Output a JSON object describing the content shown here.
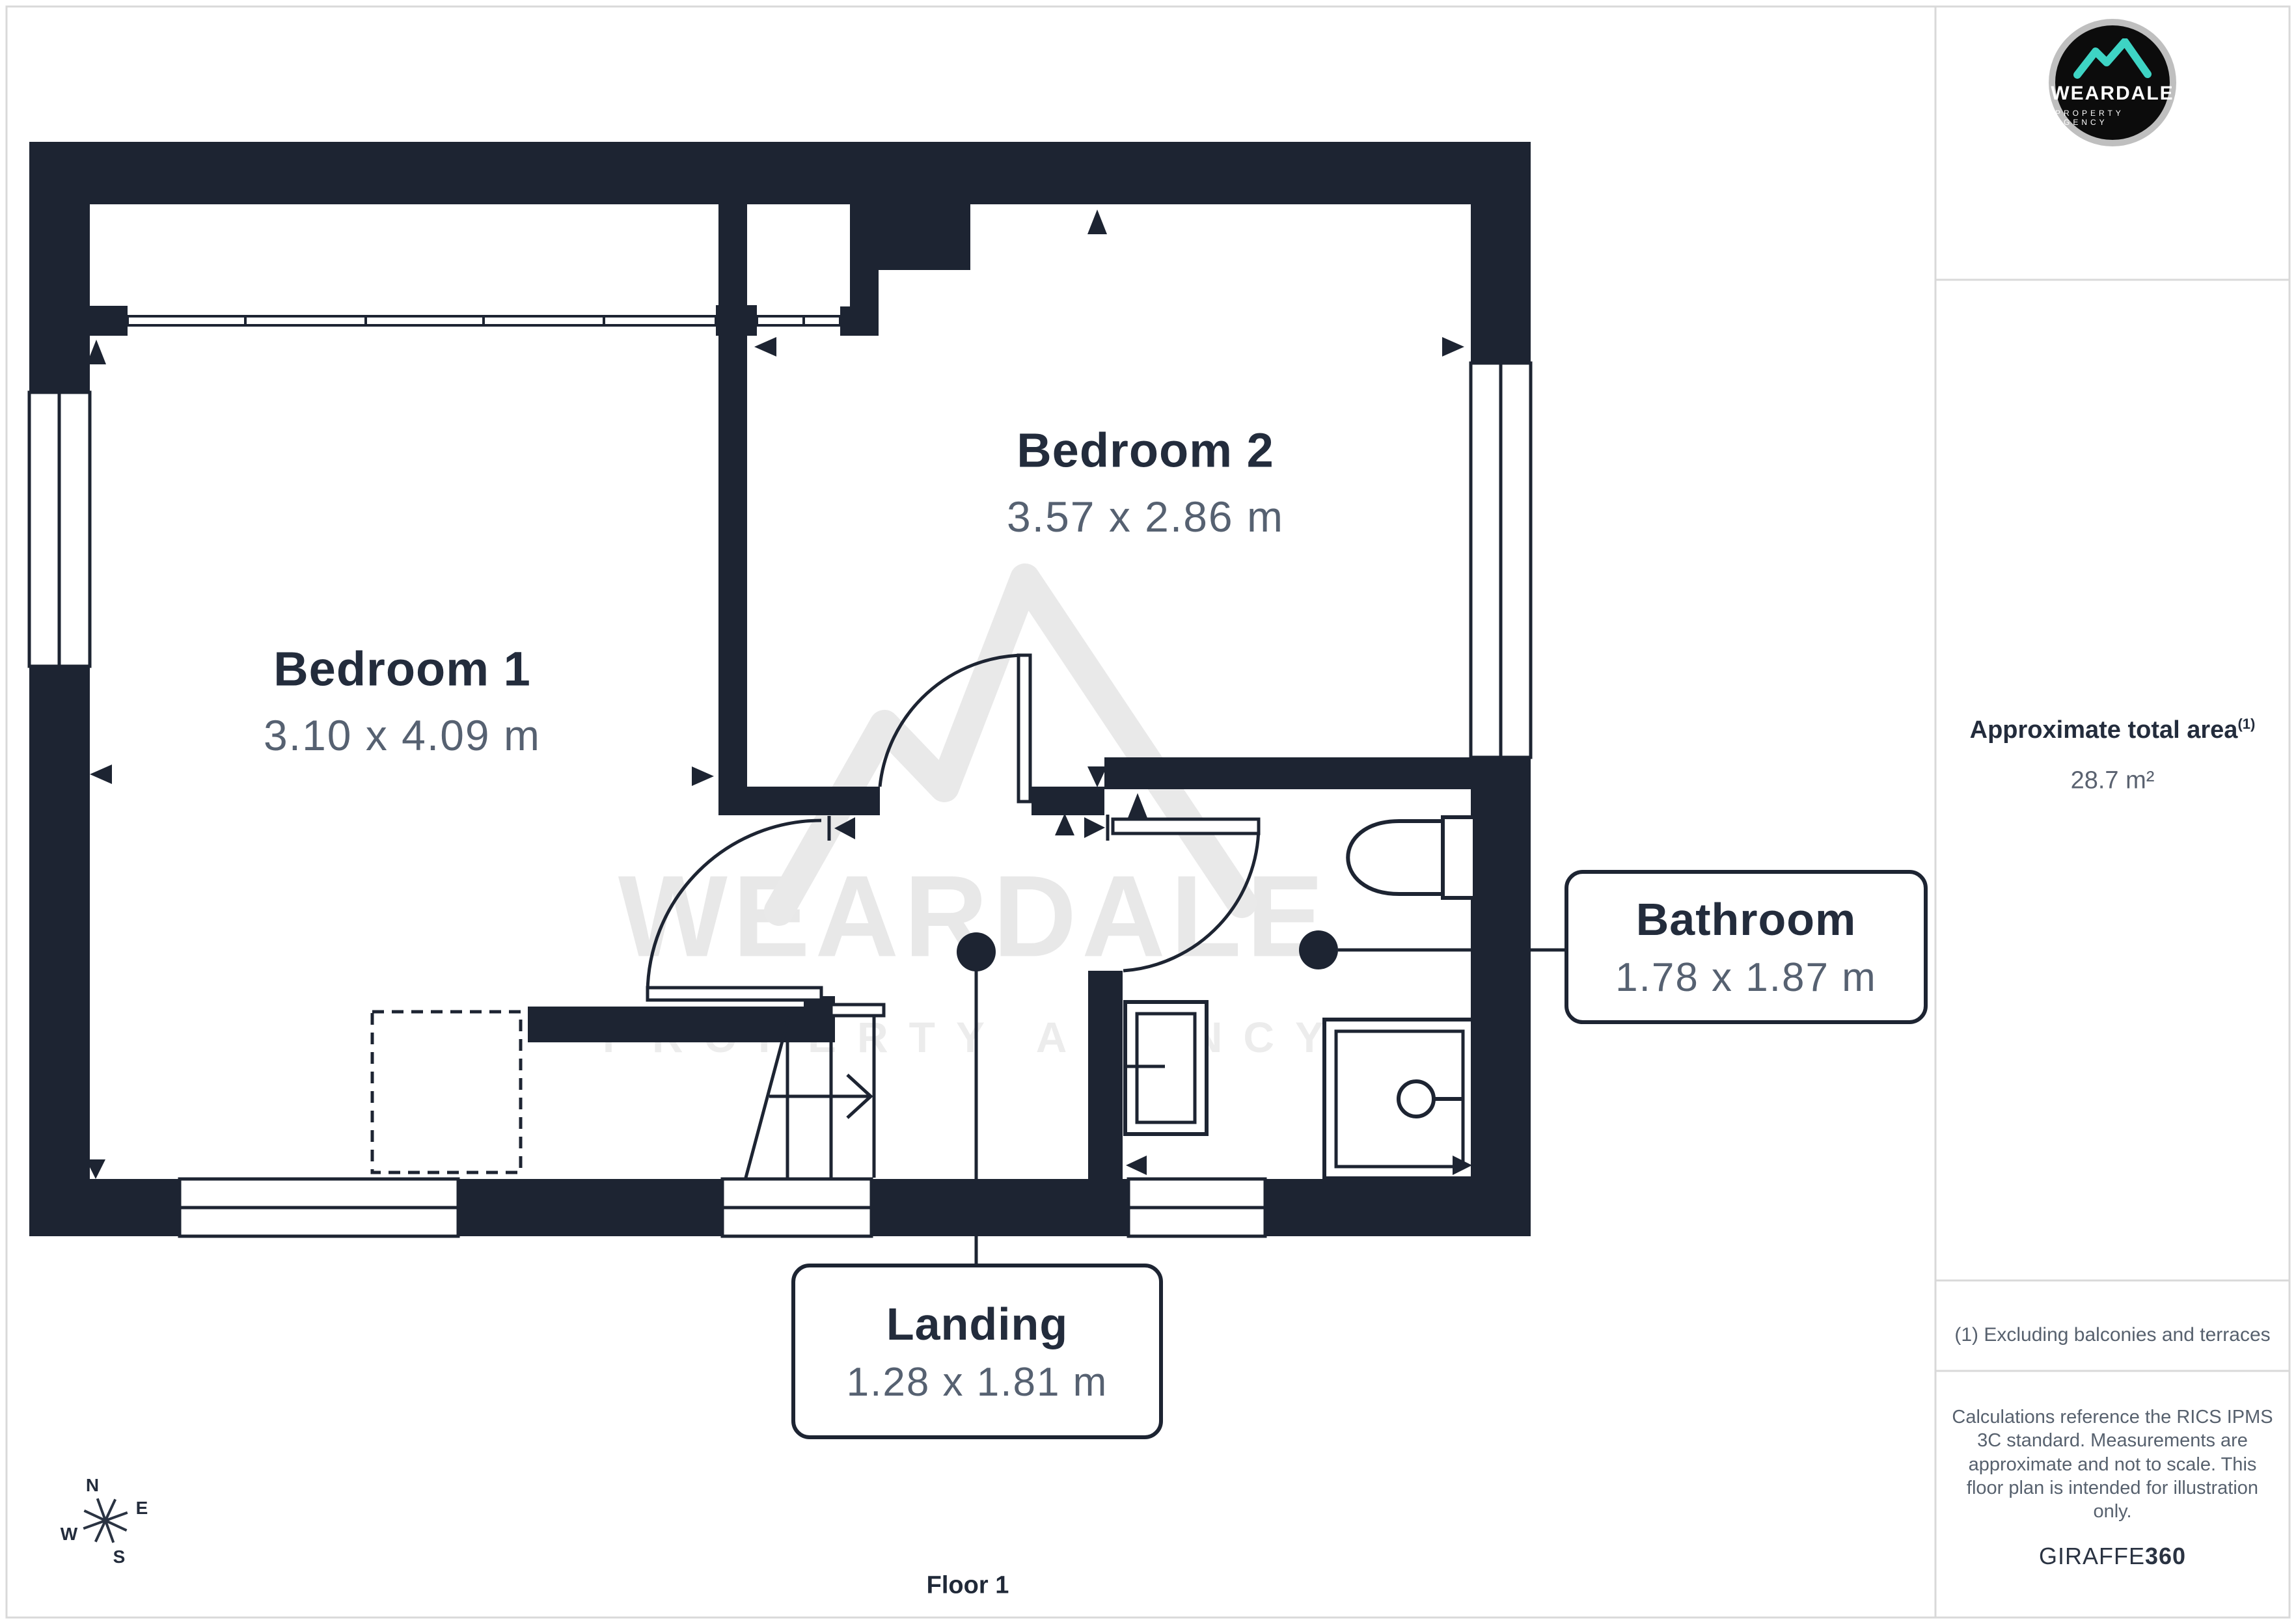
{
  "colors": {
    "wall": "#1d2432",
    "label_dark": "#232c3c",
    "label_gray": "#566171",
    "watermark": "#e8e8e8",
    "border_gray": "#d9d9d9",
    "teal": "#3ed4c4",
    "logo_ring": "#bfbfbf",
    "logo_bg": "#0c0c0c"
  },
  "plan": {
    "rooms": [
      {
        "name": "Bedroom 1",
        "dims": "3.10 x 4.09 m"
      },
      {
        "name": "Bedroom 2",
        "dims": "3.57 x 2.86 m"
      }
    ],
    "callouts": [
      {
        "name": "Bathroom",
        "dims": "1.78 x 1.87 m"
      },
      {
        "name": "Landing",
        "dims": "1.28 x 1.81 m"
      }
    ],
    "floor_label": "Floor 1",
    "compass": {
      "n": "N",
      "e": "E",
      "s": "S",
      "w": "W"
    }
  },
  "watermark": {
    "brand": "WEARDALE",
    "tagline": "PROPERTY AGENCY"
  },
  "sidebar": {
    "logo": {
      "brand": "WEARDALE",
      "tagline": "PROPERTY AGENCY"
    },
    "area": {
      "title": "Approximate total area",
      "superscript": "(1)",
      "value": "28.7 m²"
    },
    "footnote": "(1) Excluding balconies and terraces",
    "disclaimer": "Calculations reference the RICS IPMS 3C standard. Measurements are approximate and not to scale. This floor plan is intended for illustration only.",
    "credit": {
      "brand": "GIRAFFE",
      "suffix": "360"
    }
  }
}
